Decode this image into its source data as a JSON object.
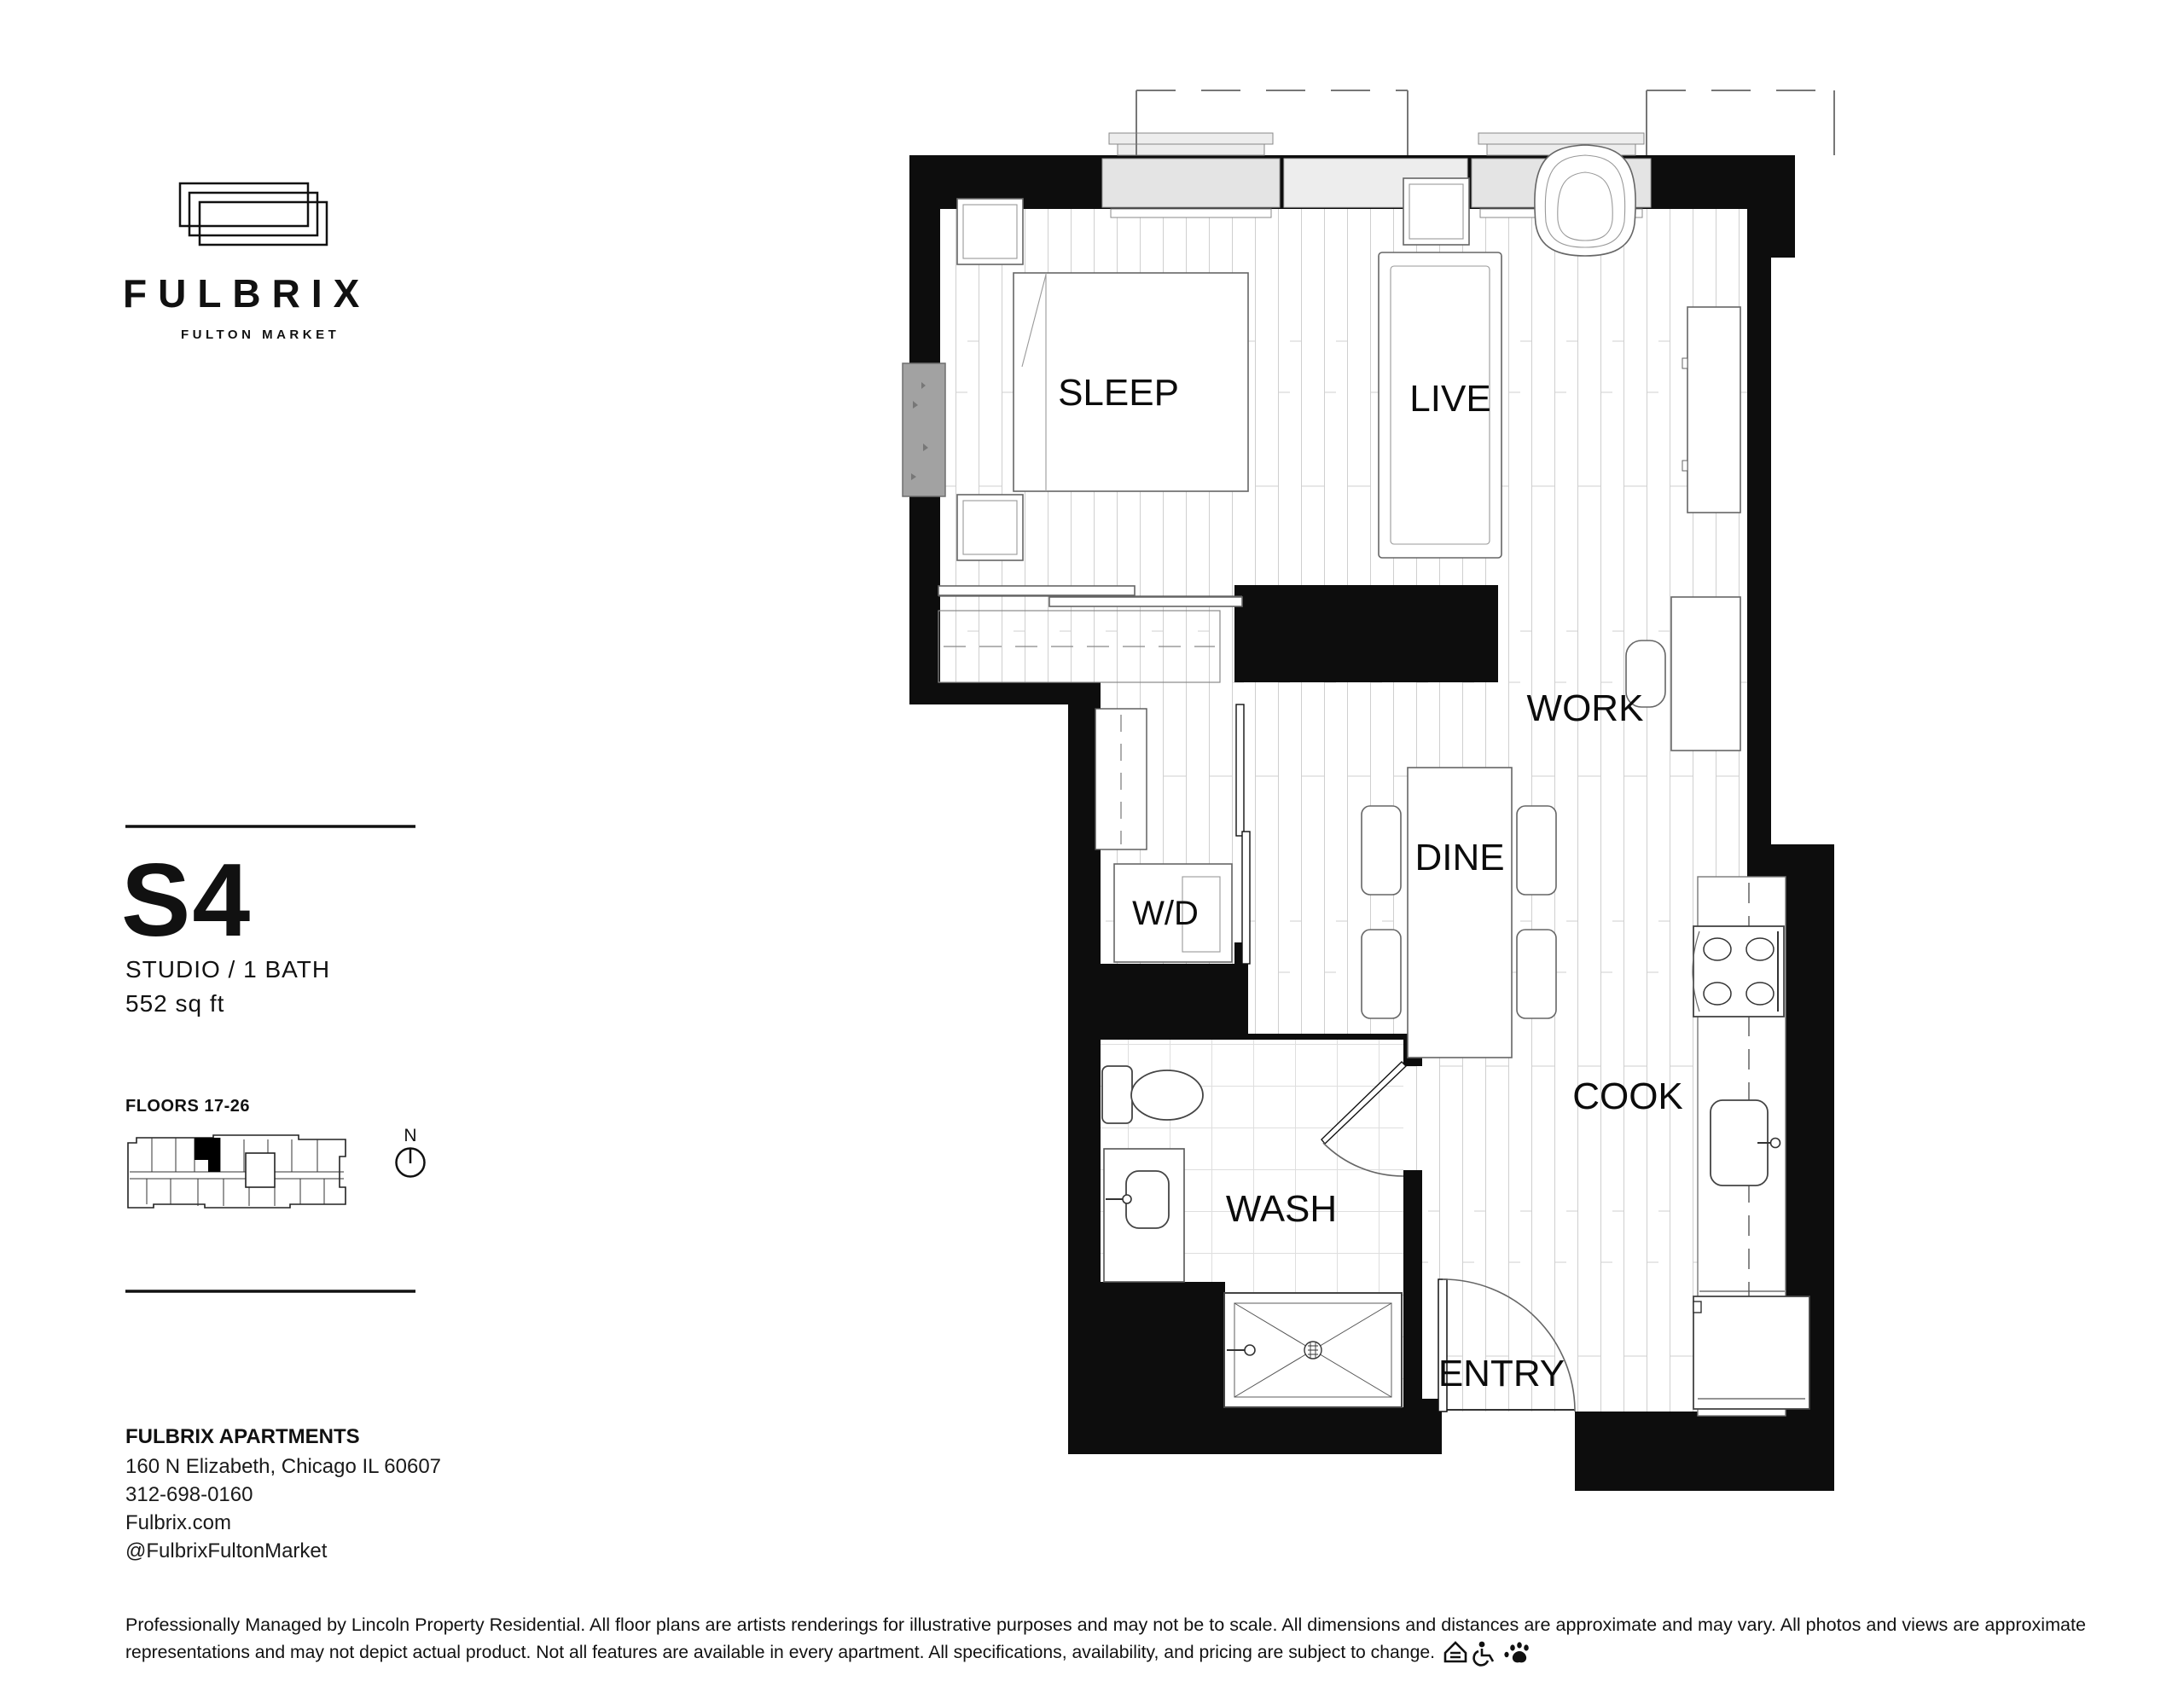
{
  "brand": {
    "name": "FULBRIX",
    "tagline": "FULTON MARKET"
  },
  "unit": {
    "code": "S4",
    "type": "STUDIO / 1 BATH",
    "area": "552 sq ft",
    "floors": "FLOORS 17-26"
  },
  "compass": {
    "label": "N"
  },
  "rooms": {
    "sleep": "SLEEP",
    "live": "LIVE",
    "work": "WORK",
    "dine": "DINE",
    "wd": "W/D",
    "wash": "WASH",
    "cook": "COOK",
    "entry": "ENTRY"
  },
  "contact": {
    "name": "FULBRIX APARTMENTS",
    "address": "160 N Elizabeth, Chicago IL 60607",
    "phone": "312-698-0160",
    "website": "Fulbrix.com",
    "social": "@FulbrixFultonMarket"
  },
  "disclaimer": {
    "line1": "Professionally Managed by Lincoln Property Residential. All floor plans are artists renderings for illustrative purposes and may not be to scale. All dimensions and distances are approximate and may vary. All photos and views are approximate",
    "line2": "representations and may not depict actual product. Not all features are available in every apartment. All specifications, availability, and pricing are subject to change."
  },
  "icons": {
    "equal_housing": "equal-housing-icon",
    "accessibility": "accessibility-icon",
    "pet_friendly": "paw-icon",
    "compass": "north-compass-icon",
    "logo_mark": "stacked-bricks-logo-icon"
  },
  "colors": {
    "wall": "#0d0d0d",
    "window_fill": "#e4e4e4",
    "spandrel_fill": "#ededed",
    "concrete_column": "#a2a2a2",
    "plank_line": "#cfcfcf"
  }
}
